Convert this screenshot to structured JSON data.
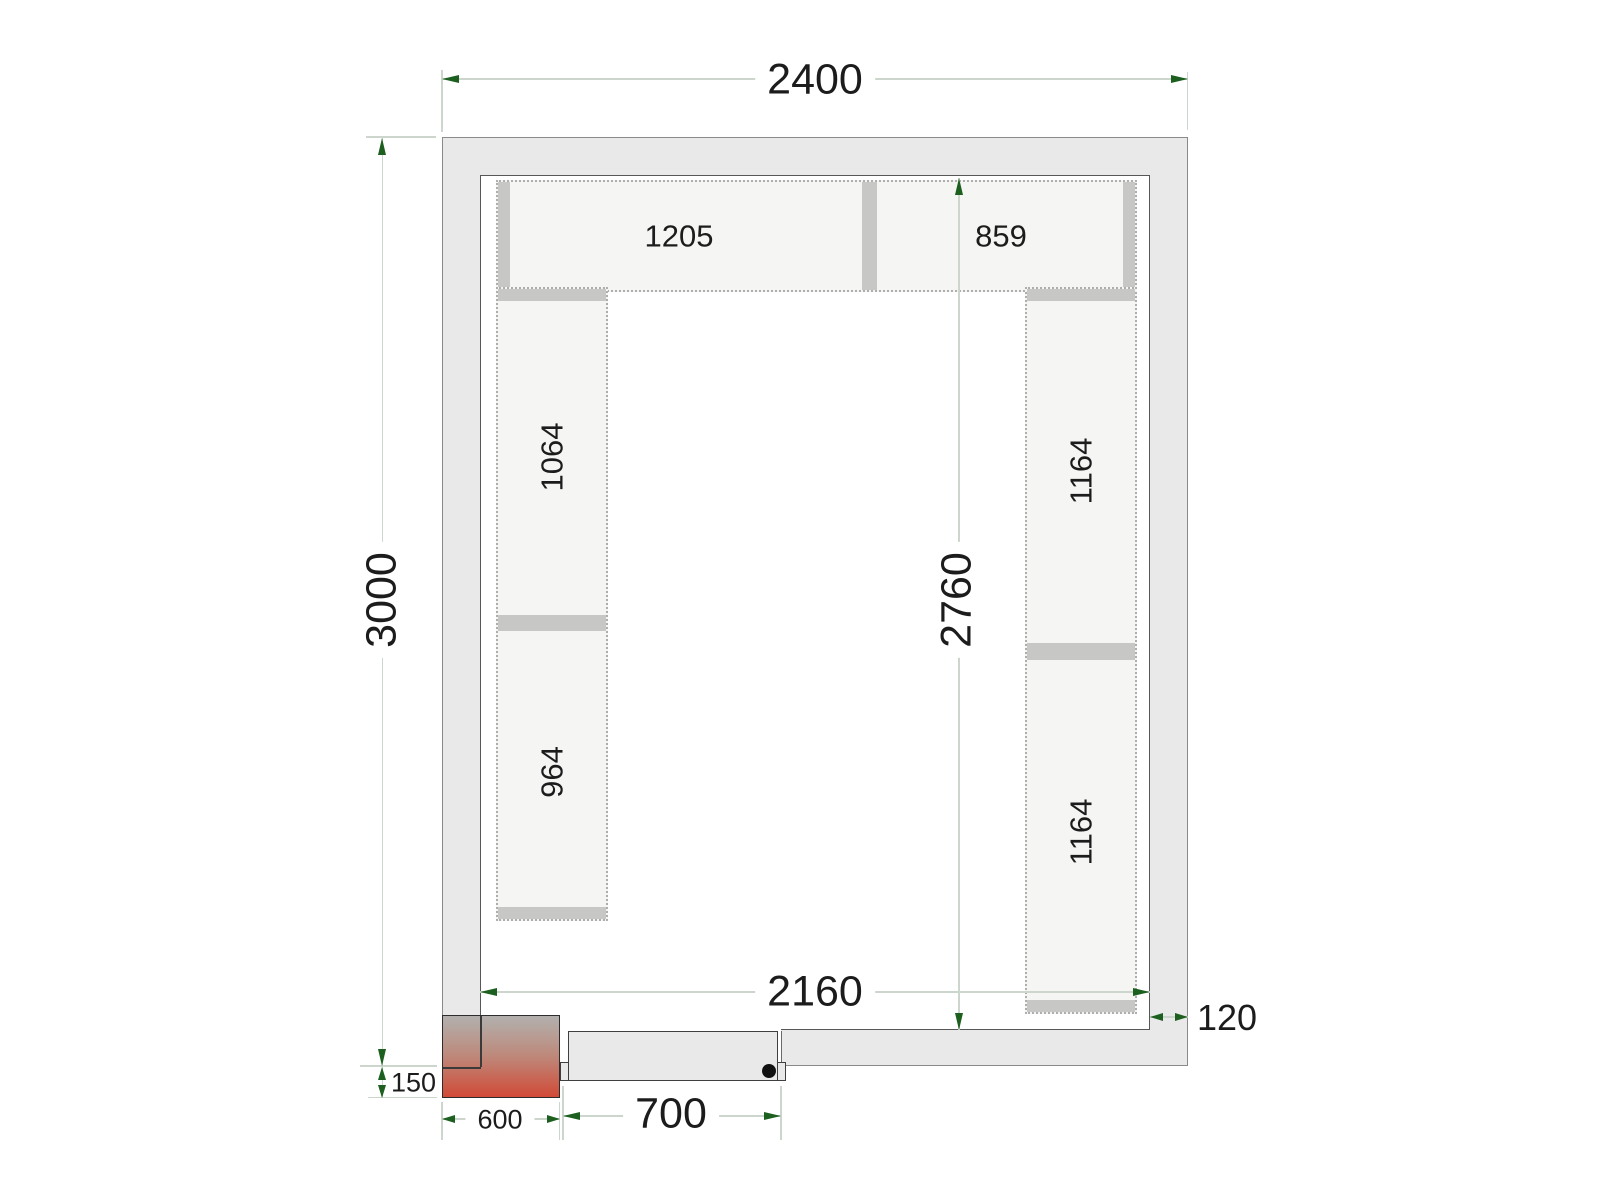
{
  "dimensions": {
    "outer_width": "2400",
    "outer_height": "3000",
    "inner_width": "2160",
    "inner_height": "2760",
    "wall_thickness": "120",
    "unit_offset": "150",
    "unit_width": "600",
    "door_width": "700"
  },
  "shelves": {
    "top_left": "1205",
    "top_right": "859",
    "left_upper": "1064",
    "left_lower": "964",
    "right_upper": "1164",
    "right_lower": "1164"
  },
  "colors": {
    "wall_fill": "#e9e9e9",
    "wall_outer_stroke": "#8a8a8a",
    "wall_inner_stroke": "#575757",
    "shelf_fill": "#f5f5f4",
    "shelf_dotted_border": "#aeaeae",
    "shelf_cap": "#c7c7c6",
    "dimension_line": "#ccd6cc",
    "dimension_arrow": "#1c5f1f",
    "unit_gradient_top": "#b2b0ae",
    "unit_gradient_bottom": "#d14a37",
    "door_fill": "#e9e9e9",
    "handle_dot": "#111111",
    "text": "#1c1c1c"
  }
}
